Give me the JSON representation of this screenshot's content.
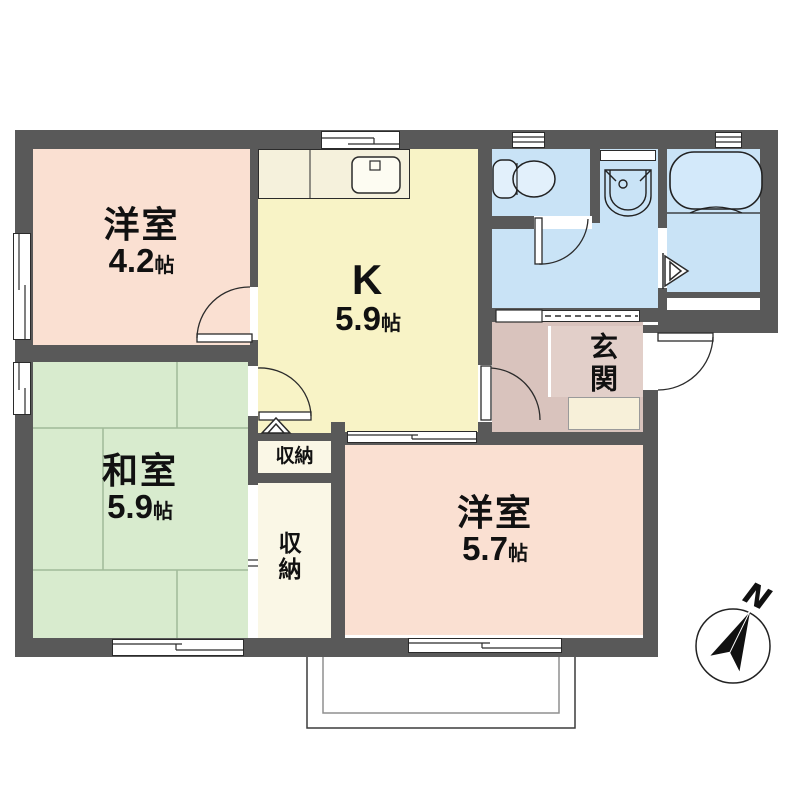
{
  "floorplan": {
    "rooms": {
      "western1": {
        "label": "洋室",
        "size": "4.2",
        "unit": "帖"
      },
      "kitchen": {
        "label": "K",
        "size": "5.9",
        "unit": "帖"
      },
      "japanese": {
        "label": "和室",
        "size": "5.9",
        "unit": "帖"
      },
      "western2": {
        "label": "洋室",
        "size": "5.7",
        "unit": "帖"
      },
      "entrance": {
        "label": "玄関"
      },
      "closet_upper": {
        "label": "収納"
      },
      "closet_lower": {
        "label": "収納"
      }
    },
    "compass": {
      "north_label": "N"
    },
    "icons": [
      "toilet-icon",
      "bathtub-icon",
      "washbasin-icon",
      "kitchen-sink-icon",
      "north-arrow-icon",
      "door-arc-icon",
      "folding-door-icon",
      "sliding-door-icon",
      "window-icon"
    ],
    "colors": {
      "wall": "#595959",
      "western_room": "#FAE0D2",
      "kitchen": "#F8F3C6",
      "kitchen_counter": "#F5F1DC",
      "japanese_room": "#D8EBCE",
      "sanitary": "#C9E3F6",
      "entrance": "#D9C3BD",
      "entrance_step": "#F7F0D9",
      "closet": "#FAF7E6"
    }
  }
}
